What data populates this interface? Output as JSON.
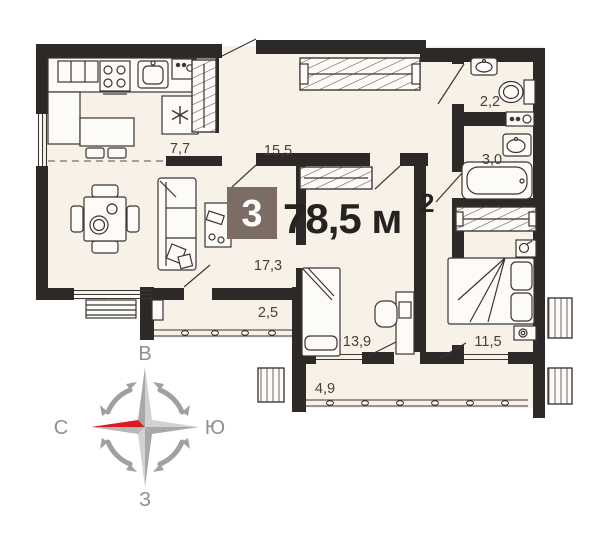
{
  "floor_plan": {
    "badge_rooms": "3",
    "total_area": {
      "value": "78,5 м",
      "sup": "2"
    },
    "areas": {
      "kitchen": "7,7",
      "hallway": "15,5",
      "wc": "2,2",
      "bathroom": "3,0",
      "living": "17,3",
      "loggia": "2,5",
      "bedroom_1": "13,9",
      "bedroom_2": "11,5",
      "balcony": "4,9"
    },
    "compass": {
      "top": "В",
      "right": "Ю",
      "left": "С",
      "bottom": "З"
    },
    "watermark": "Avito",
    "colors": {
      "wall": "#2d2926",
      "floor": "#f7f1e8",
      "badge": "#7b6c64",
      "north_red": "#dd1a21"
    }
  }
}
